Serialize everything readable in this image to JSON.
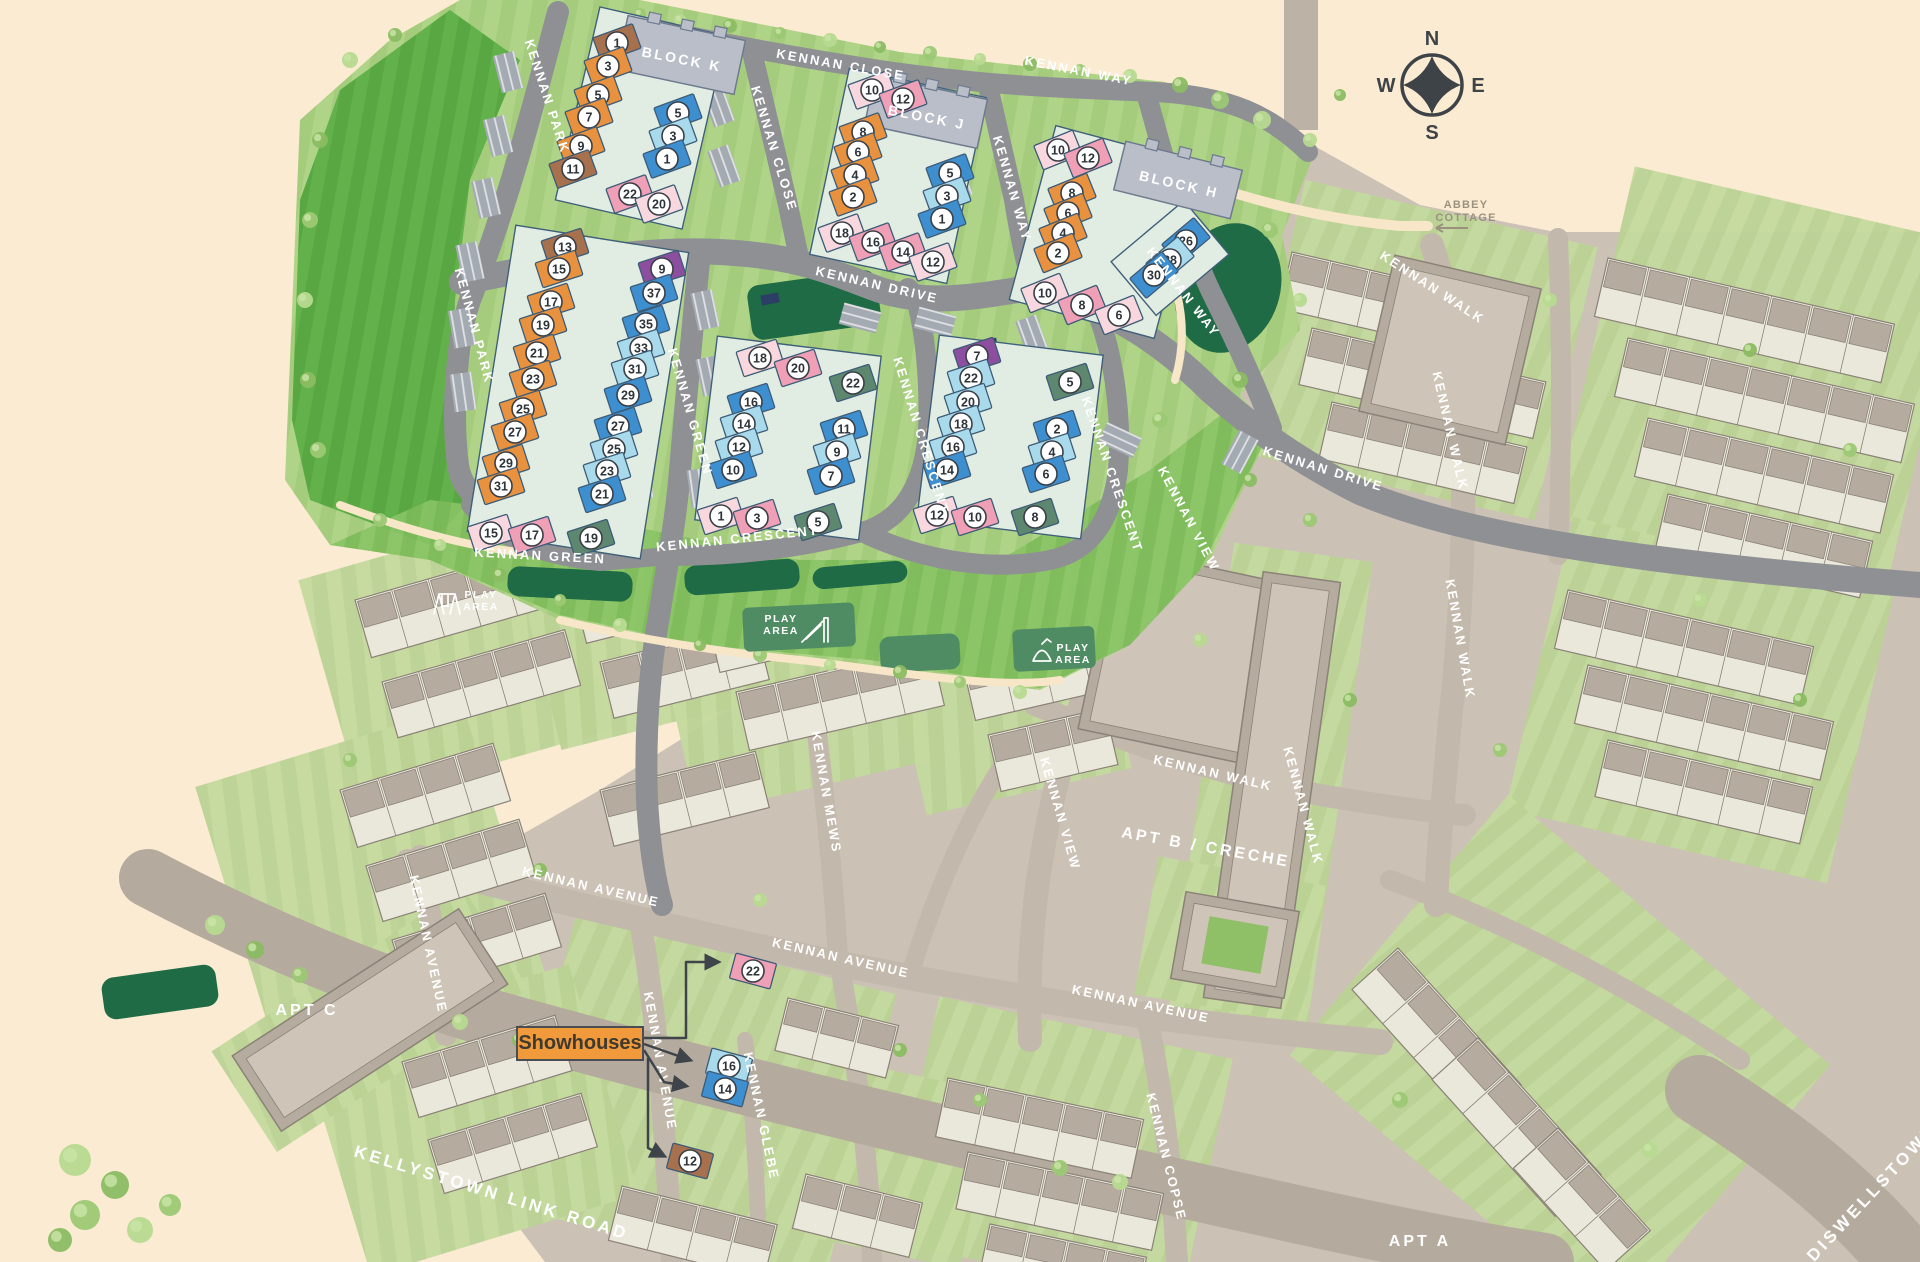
{
  "compass": {
    "north": "N",
    "east": "E",
    "south": "S",
    "west": "W"
  },
  "annotations": {
    "showhouses_label": "Showhouses",
    "abbey_cottage_line1": "ABBEY",
    "abbey_cottage_line2": "COTTAGE",
    "play_area_label": "PLAY AREA"
  },
  "apartments": [
    {
      "label": "APT C",
      "x": 307,
      "y": 1015,
      "rot": 0
    },
    {
      "label": "APT B / CRECHE",
      "x": 1205,
      "y": 852,
      "rot": 10
    },
    {
      "label": "APT A",
      "x": 1420,
      "y": 1246,
      "rot": 0
    }
  ],
  "blocks": [
    {
      "label": "BLOCK K",
      "x": 681,
      "y": 64,
      "rot": 11
    },
    {
      "label": "BLOCK J",
      "x": 926,
      "y": 122,
      "rot": 11
    },
    {
      "label": "BLOCK H",
      "x": 1178,
      "y": 189,
      "rot": 13
    }
  ],
  "main_roads": [
    {
      "label": "KELLYSTOWN LINK ROAD",
      "x": 490,
      "y": 1198,
      "rot": 17
    },
    {
      "label": "DISWELLSTOWN",
      "x": 1876,
      "y": 1196,
      "rot": -47
    }
  ],
  "streets": [
    {
      "t": "KENNAN PARK",
      "x": 543,
      "y": 98,
      "r": 72
    },
    {
      "t": "KENNAN PARK",
      "x": 470,
      "y": 327,
      "r": 75
    },
    {
      "t": "KENNAN CLOSE",
      "x": 840,
      "y": 69,
      "r": 10
    },
    {
      "t": "KENNAN CLOSE",
      "x": 770,
      "y": 150,
      "r": 73
    },
    {
      "t": "KENNAN WAY",
      "x": 1078,
      "y": 75,
      "r": 11
    },
    {
      "t": "KENNAN WAY",
      "x": 1008,
      "y": 190,
      "r": 74
    },
    {
      "t": "KENNAN WAY",
      "x": 1180,
      "y": 295,
      "r": 52
    },
    {
      "t": "KENNAN DRIVE",
      "x": 876,
      "y": 289,
      "r": 13
    },
    {
      "t": "KENNAN GREEN",
      "x": 540,
      "y": 560,
      "r": 3
    },
    {
      "t": "KENNAN GREEN",
      "x": 686,
      "y": 413,
      "r": 74
    },
    {
      "t": "KENNAN CRESCENT",
      "x": 738,
      "y": 543,
      "r": -6
    },
    {
      "t": "KENNAN CRESCENT",
      "x": 917,
      "y": 437,
      "r": 73
    },
    {
      "t": "KENNAN CRESCENT",
      "x": 1108,
      "y": 476,
      "r": 71
    },
    {
      "t": "KENNAN VIEW",
      "x": 1185,
      "y": 521,
      "r": 62
    },
    {
      "t": "KENNAN VIEW",
      "x": 1056,
      "y": 815,
      "r": 74
    },
    {
      "t": "KENNAN DRIVE",
      "x": 1322,
      "y": 473,
      "r": 17
    },
    {
      "t": "KENNAN WALK",
      "x": 1430,
      "y": 291,
      "r": 33
    },
    {
      "t": "KENNAN WALK",
      "x": 1446,
      "y": 432,
      "r": 77
    },
    {
      "t": "KENNAN WALK",
      "x": 1456,
      "y": 640,
      "r": 80
    },
    {
      "t": "KENNAN WALK",
      "x": 1212,
      "y": 777,
      "r": 13
    },
    {
      "t": "KENNAN WALK",
      "x": 1299,
      "y": 807,
      "r": 75
    },
    {
      "t": "KENNAN MEWS",
      "x": 822,
      "y": 793,
      "r": 80
    },
    {
      "t": "KENNAN AVENUE",
      "x": 590,
      "y": 891,
      "r": 13
    },
    {
      "t": "KENNAN AVENUE",
      "x": 424,
      "y": 945,
      "r": 78
    },
    {
      "t": "KENNAN AVENUE",
      "x": 840,
      "y": 962,
      "r": 13
    },
    {
      "t": "KENNAN AVENUE",
      "x": 656,
      "y": 1062,
      "r": 80
    },
    {
      "t": "KENNAN AVENUE",
      "x": 1140,
      "y": 1008,
      "r": 12
    },
    {
      "t": "KENNAN COPSE",
      "x": 1162,
      "y": 1158,
      "r": 76
    },
    {
      "t": "KENNAN GLEBE",
      "x": 757,
      "y": 1117,
      "r": 78
    }
  ],
  "play_areas": [
    {
      "x": 446,
      "y": 604,
      "icon": "swing",
      "tx": 481,
      "ty": 604,
      "patch": false
    },
    {
      "x": 816,
      "y": 630,
      "icon": "slide",
      "tx": 781,
      "ty": 628,
      "patch": true,
      "px": 742,
      "py": 608,
      "pw": 112,
      "ph": 44
    },
    {
      "x": 1042,
      "y": 652,
      "icon": "rocker",
      "tx": 1073,
      "ty": 657,
      "patch": true,
      "px": 1012,
      "py": 630,
      "pw": 82,
      "ph": 42
    }
  ],
  "unit_colors": {
    "orange": "#E8923F",
    "brown": "#A8714E",
    "blue": "#3E8FD0",
    "ltblue": "#A9DAEC",
    "pink": "#EF9FB6",
    "ltpink": "#F8D8DE",
    "purple": "#8C4E9E",
    "green": "#5E8770"
  },
  "clusters": [
    {
      "name": "block-k-cluster",
      "rot": -20,
      "units": [
        {
          "n": "1",
          "x": 617,
          "y": 43,
          "c": "brown"
        },
        {
          "n": "3",
          "x": 608,
          "y": 66,
          "c": "orange"
        },
        {
          "n": "5",
          "x": 598,
          "y": 95,
          "c": "orange"
        },
        {
          "n": "7",
          "x": 589,
          "y": 117,
          "c": "orange"
        },
        {
          "n": "9",
          "x": 581,
          "y": 146,
          "c": "orange"
        },
        {
          "n": "11",
          "x": 573,
          "y": 169,
          "c": "brown"
        },
        {
          "n": "5",
          "x": 678,
          "y": 113,
          "c": "blue"
        },
        {
          "n": "3",
          "x": 673,
          "y": 136,
          "c": "ltblue"
        },
        {
          "n": "1",
          "x": 667,
          "y": 159,
          "c": "blue"
        },
        {
          "n": "22",
          "x": 630,
          "y": 194,
          "c": "pink"
        },
        {
          "n": "20",
          "x": 659,
          "y": 204,
          "c": "ltpink"
        }
      ]
    },
    {
      "name": "block-j-cluster",
      "rot": -20,
      "units": [
        {
          "n": "10",
          "x": 872,
          "y": 90,
          "c": "ltpink"
        },
        {
          "n": "12",
          "x": 903,
          "y": 99,
          "c": "pink"
        },
        {
          "n": "8",
          "x": 863,
          "y": 132,
          "c": "orange"
        },
        {
          "n": "6",
          "x": 858,
          "y": 152,
          "c": "orange"
        },
        {
          "n": "4",
          "x": 855,
          "y": 175,
          "c": "orange"
        },
        {
          "n": "2",
          "x": 853,
          "y": 197,
          "c": "orange"
        },
        {
          "n": "5",
          "x": 950,
          "y": 173,
          "c": "blue"
        },
        {
          "n": "3",
          "x": 947,
          "y": 196,
          "c": "ltblue"
        },
        {
          "n": "1",
          "x": 942,
          "y": 219,
          "c": "blue"
        },
        {
          "n": "18",
          "x": 842,
          "y": 233,
          "c": "ltpink"
        },
        {
          "n": "16",
          "x": 873,
          "y": 242,
          "c": "pink"
        },
        {
          "n": "14",
          "x": 903,
          "y": 252,
          "c": "pink"
        },
        {
          "n": "12",
          "x": 933,
          "y": 262,
          "c": "ltpink"
        }
      ]
    },
    {
      "name": "block-h-cluster",
      "rot": -22,
      "units": [
        {
          "n": "10",
          "x": 1058,
          "y": 150,
          "c": "ltpink"
        },
        {
          "n": "12",
          "x": 1088,
          "y": 158,
          "c": "pink"
        },
        {
          "n": "8",
          "x": 1072,
          "y": 193,
          "c": "orange"
        },
        {
          "n": "6",
          "x": 1068,
          "y": 213,
          "c": "orange"
        },
        {
          "n": "4",
          "x": 1063,
          "y": 233,
          "c": "orange"
        },
        {
          "n": "2",
          "x": 1058,
          "y": 253,
          "c": "orange"
        },
        {
          "n": "26",
          "x": 1186,
          "y": 241,
          "c": "blue",
          "rr": -40
        },
        {
          "n": "28",
          "x": 1170,
          "y": 260,
          "c": "ltblue",
          "rr": -40
        },
        {
          "n": "30",
          "x": 1154,
          "y": 275,
          "c": "blue",
          "rr": -40
        },
        {
          "n": "10",
          "x": 1045,
          "y": 293,
          "c": "ltpink"
        },
        {
          "n": "8",
          "x": 1082,
          "y": 305,
          "c": "pink"
        },
        {
          "n": "6",
          "x": 1119,
          "y": 315,
          "c": "ltpink"
        }
      ]
    },
    {
      "name": "kennan-park-cluster",
      "rot": -18,
      "units": [
        {
          "n": "13",
          "x": 565,
          "y": 247,
          "c": "brown"
        },
        {
          "n": "15",
          "x": 559,
          "y": 269,
          "c": "orange"
        },
        {
          "n": "17",
          "x": 551,
          "y": 302,
          "c": "orange"
        },
        {
          "n": "19",
          "x": 543,
          "y": 325,
          "c": "orange"
        },
        {
          "n": "21",
          "x": 537,
          "y": 353,
          "c": "orange"
        },
        {
          "n": "23",
          "x": 533,
          "y": 379,
          "c": "orange"
        },
        {
          "n": "25",
          "x": 523,
          "y": 409,
          "c": "orange"
        },
        {
          "n": "27",
          "x": 515,
          "y": 432,
          "c": "orange"
        },
        {
          "n": "29",
          "x": 506,
          "y": 463,
          "c": "orange"
        },
        {
          "n": "31",
          "x": 501,
          "y": 486,
          "c": "orange"
        },
        {
          "n": "9",
          "x": 662,
          "y": 269,
          "c": "purple"
        },
        {
          "n": "37",
          "x": 654,
          "y": 293,
          "c": "blue"
        },
        {
          "n": "35",
          "x": 646,
          "y": 324,
          "c": "blue"
        },
        {
          "n": "33",
          "x": 641,
          "y": 348,
          "c": "ltblue"
        },
        {
          "n": "31",
          "x": 635,
          "y": 369,
          "c": "ltblue"
        },
        {
          "n": "29",
          "x": 628,
          "y": 395,
          "c": "blue"
        },
        {
          "n": "27",
          "x": 618,
          "y": 426,
          "c": "blue"
        },
        {
          "n": "25",
          "x": 614,
          "y": 449,
          "c": "ltblue"
        },
        {
          "n": "23",
          "x": 607,
          "y": 471,
          "c": "ltblue"
        },
        {
          "n": "21",
          "x": 602,
          "y": 494,
          "c": "blue"
        },
        {
          "n": "15",
          "x": 491,
          "y": 533,
          "c": "ltpink"
        },
        {
          "n": "17",
          "x": 532,
          "y": 535,
          "c": "pink"
        },
        {
          "n": "19",
          "x": 591,
          "y": 538,
          "c": "green"
        }
      ]
    },
    {
      "name": "green-crescent-cluster",
      "rot": -18,
      "units": [
        {
          "n": "18",
          "x": 760,
          "y": 358,
          "c": "ltpink"
        },
        {
          "n": "20",
          "x": 798,
          "y": 368,
          "c": "pink"
        },
        {
          "n": "22",
          "x": 853,
          "y": 383,
          "c": "green"
        },
        {
          "n": "16",
          "x": 751,
          "y": 402,
          "c": "blue"
        },
        {
          "n": "14",
          "x": 744,
          "y": 424,
          "c": "ltblue"
        },
        {
          "n": "12",
          "x": 739,
          "y": 447,
          "c": "ltblue"
        },
        {
          "n": "10",
          "x": 733,
          "y": 470,
          "c": "blue"
        },
        {
          "n": "11",
          "x": 844,
          "y": 429,
          "c": "blue"
        },
        {
          "n": "9",
          "x": 837,
          "y": 452,
          "c": "ltblue"
        },
        {
          "n": "7",
          "x": 831,
          "y": 476,
          "c": "blue"
        },
        {
          "n": "1",
          "x": 721,
          "y": 516,
          "c": "ltpink"
        },
        {
          "n": "3",
          "x": 757,
          "y": 518,
          "c": "pink"
        },
        {
          "n": "5",
          "x": 818,
          "y": 522,
          "c": "green"
        }
      ]
    },
    {
      "name": "crescent-east-cluster",
      "rot": -18,
      "units": [
        {
          "n": "7",
          "x": 977,
          "y": 356,
          "c": "purple"
        },
        {
          "n": "22",
          "x": 971,
          "y": 378,
          "c": "ltblue"
        },
        {
          "n": "20",
          "x": 968,
          "y": 402,
          "c": "ltblue"
        },
        {
          "n": "18",
          "x": 961,
          "y": 424,
          "c": "ltblue"
        },
        {
          "n": "16",
          "x": 953,
          "y": 447,
          "c": "ltblue"
        },
        {
          "n": "14",
          "x": 947,
          "y": 470,
          "c": "blue"
        },
        {
          "n": "5",
          "x": 1070,
          "y": 382,
          "c": "green"
        },
        {
          "n": "2",
          "x": 1057,
          "y": 429,
          "c": "blue"
        },
        {
          "n": "4",
          "x": 1052,
          "y": 452,
          "c": "ltblue"
        },
        {
          "n": "6",
          "x": 1046,
          "y": 474,
          "c": "blue"
        },
        {
          "n": "12",
          "x": 937,
          "y": 515,
          "c": "ltpink"
        },
        {
          "n": "10",
          "x": 975,
          "y": 517,
          "c": "pink"
        },
        {
          "n": "8",
          "x": 1035,
          "y": 517,
          "c": "green"
        }
      ]
    },
    {
      "name": "showhouse-cluster",
      "rot": 15,
      "units": [
        {
          "n": "22",
          "x": 753,
          "y": 971,
          "c": "pink"
        },
        {
          "n": "16",
          "x": 729,
          "y": 1066,
          "c": "ltblue"
        },
        {
          "n": "14",
          "x": 725,
          "y": 1089,
          "c": "blue"
        },
        {
          "n": "12",
          "x": 690,
          "y": 1161,
          "c": "brown"
        }
      ]
    }
  ]
}
